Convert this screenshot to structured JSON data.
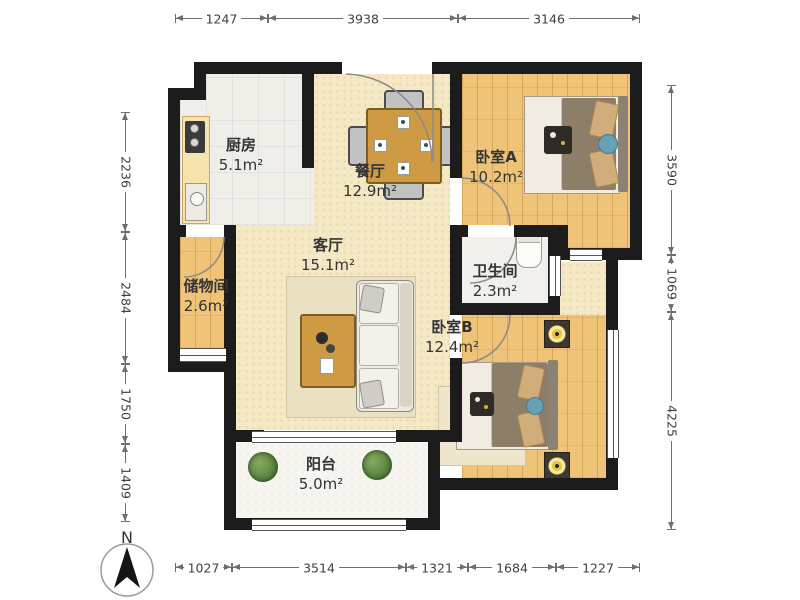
{
  "plan": {
    "rooms": {
      "kitchen": {
        "name": "厨房",
        "area": "5.1m²"
      },
      "dining": {
        "name": "餐厅",
        "area": "12.9m²"
      },
      "bedroom_a": {
        "name": "卧室A",
        "area": "10.2m²"
      },
      "living": {
        "name": "客厅",
        "area": "15.1m²"
      },
      "storage": {
        "name": "储物间",
        "area": "2.6m²"
      },
      "bathroom": {
        "name": "卫生间",
        "area": "2.3m²"
      },
      "bedroom_b": {
        "name": "卧室B",
        "area": "12.4m²"
      },
      "balcony": {
        "name": "阳台",
        "area": "5.0m²"
      }
    },
    "dimensions": {
      "top": [
        "1247",
        "3938",
        "3146"
      ],
      "right": [
        "3590",
        "1069",
        "4225"
      ],
      "bottom": [
        "1027",
        "3514",
        "1321",
        "1684",
        "1227"
      ],
      "left": [
        "2236",
        "2484",
        "1750",
        "1409"
      ]
    },
    "compass": {
      "label": "N"
    },
    "colors": {
      "wall": "#1c1c1c",
      "wood_floor": "#efc478",
      "main_floor": "#f4e8c5",
      "kitchen_floor": "#efeee9",
      "table_wood": "#cf9a44",
      "blanket": "#8d7e69",
      "plant": "#5c8743",
      "dimension_text": "#3f3f3f"
    }
  }
}
